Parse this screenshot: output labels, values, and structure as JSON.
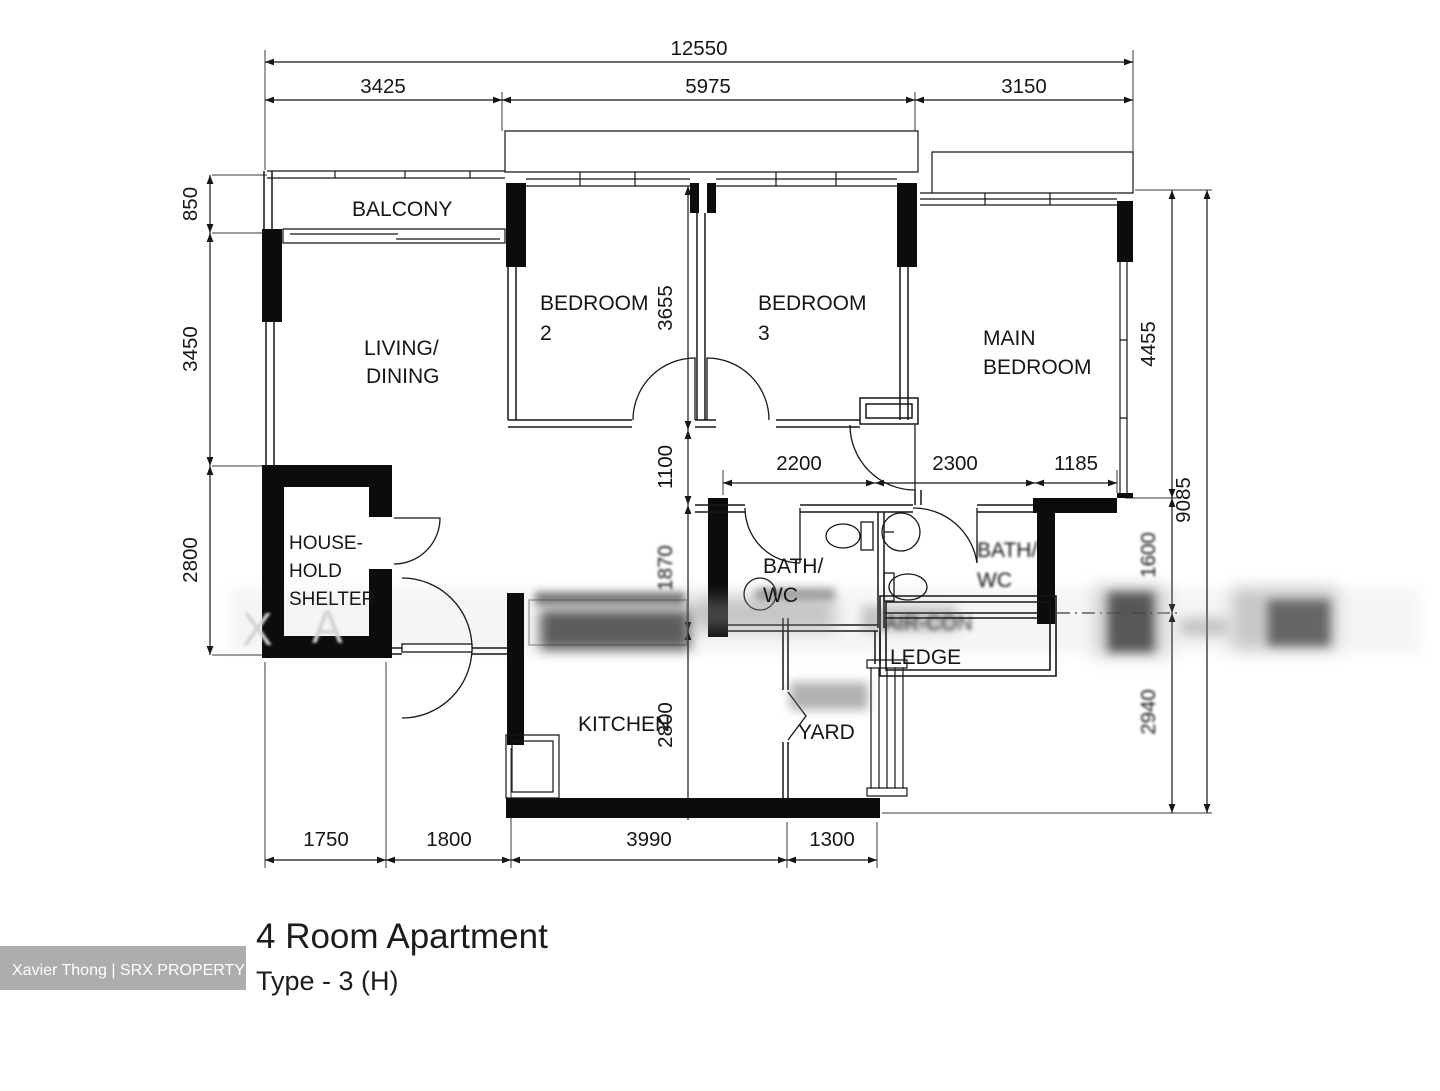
{
  "title": {
    "name": "4 Room Apartment",
    "type": "Type - 3 (H)"
  },
  "watermark": {
    "credit": "Xavier Thong | SRX PROPERTY",
    "letter_x": "X",
    "letter_a": "A"
  },
  "rooms": {
    "balcony": "BALCONY",
    "living": [
      "LIVING/",
      "DINING"
    ],
    "bedroom2": [
      "BEDROOM",
      "2"
    ],
    "bedroom3": [
      "BEDROOM",
      "3"
    ],
    "main_bedroom": [
      "MAIN",
      "BEDROOM"
    ],
    "household_shelter": [
      "HOUSE-",
      "HOLD",
      "SHELTER"
    ],
    "bath1": [
      "BATH/",
      "WC"
    ],
    "bath2": [
      "BATH/",
      "WC"
    ],
    "kitchen": "KITCHEN",
    "yard": "YARD",
    "aircon_ledge": [
      "AIR-CON",
      "LEDGE"
    ]
  },
  "dimensions": {
    "top_total": "12550",
    "top": [
      "3425",
      "5975",
      "3150"
    ],
    "left": [
      "850",
      "3450",
      "2800"
    ],
    "inner_vertical": [
      "3655",
      "1100",
      "1870",
      "2800"
    ],
    "inner_horizontal": [
      "2200",
      "2300",
      "1185"
    ],
    "right_inner": [
      "4455",
      "1600",
      "2940"
    ],
    "right_total": "9085",
    "bottom": [
      "1750",
      "1800",
      "3990",
      "1300"
    ]
  }
}
